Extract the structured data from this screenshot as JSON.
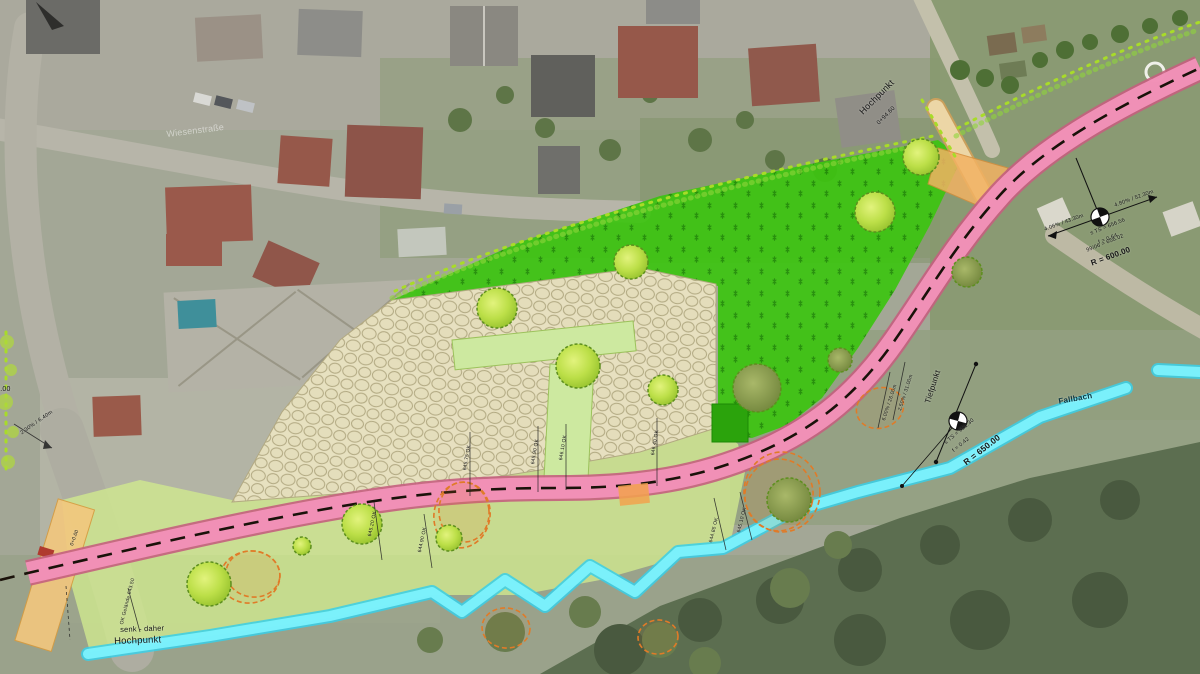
{
  "map": {
    "kind": "landscape-site-plan-over-aerial-photo",
    "colors": {
      "road_pink": "#f494bb",
      "road_edge": "#c45f7e",
      "road_centerline": "#1a120a",
      "meadow_green": "#3cc410",
      "light_green": "#cfe88e",
      "plaza_tan": "#eae3c2",
      "stream_cyan": "#7df2fd",
      "accent_orange": "#f2a24e",
      "boundary_chartreuse": "#a8dc28",
      "hedge_scribble_orange": "#e07b28"
    },
    "features": {
      "stream_name": "Fallbach",
      "high_point_label": "Hochpunkt",
      "low_point_label": "Tiefpunkt"
    }
  },
  "annotations": [
    {
      "id": "hochpunkt-top",
      "text": "Hochpunkt",
      "x": 858,
      "y": 110,
      "rot": -45,
      "size": 9
    },
    {
      "id": "hochpunkt-top-sub",
      "text": "0+94.60",
      "x": 876,
      "y": 122,
      "rot": -45,
      "size": 6
    },
    {
      "id": "grade-left",
      "text": "4.06% / 43.30m",
      "x": 1044,
      "y": 228,
      "rot": -20,
      "size": 5.5
    },
    {
      "id": "grade-right",
      "text": "4.80% / 52.30m",
      "x": 1114,
      "y": 204,
      "rot": -20,
      "size": 5.5
    },
    {
      "id": "curve1-line1",
      "text": "s TS = 656.56",
      "x": 1090,
      "y": 232,
      "rot": -22,
      "size": 5.5
    },
    {
      "id": "curve1-line2",
      "text": "f = 0.64",
      "x": 1098,
      "y": 241,
      "rot": -22,
      "size": 5.5
    },
    {
      "id": "curve1-line3",
      "text": "99/06 = 656.02",
      "x": 1086,
      "y": 249,
      "rot": -22,
      "size": 5.5
    },
    {
      "id": "curve1-radius",
      "text": "R = 600.00",
      "x": 1090,
      "y": 260,
      "rot": -20,
      "size": 8,
      "bold": true
    },
    {
      "id": "tiefpunkt",
      "text": "Tiefpunkt",
      "x": 924,
      "y": 402,
      "rot": -72,
      "size": 8
    },
    {
      "id": "grade-mid1",
      "text": "2.50% / 31.00m",
      "x": 898,
      "y": 410,
      "rot": -72,
      "size": 5
    },
    {
      "id": "grade-mid2",
      "text": "6.00% / 26.00m",
      "x": 882,
      "y": 420,
      "rot": -72,
      "size": 5
    },
    {
      "id": "curve2-line1",
      "text": "s TS = 651.30",
      "x": 944,
      "y": 442,
      "rot": -40,
      "size": 5.5
    },
    {
      "id": "curve2-line2",
      "text": "f = 0.42",
      "x": 952,
      "y": 450,
      "rot": -40,
      "size": 5.5
    },
    {
      "id": "curve2-radius",
      "text": "R = 650.00",
      "x": 962,
      "y": 460,
      "rot": -38,
      "size": 8.5,
      "bold": true
    },
    {
      "id": "stream-name",
      "text": "Fallbach",
      "x": 1058,
      "y": 398,
      "rot": -10,
      "size": 8,
      "bold": true,
      "color": "#0b3540"
    },
    {
      "id": "note-bottom-1",
      "text": "senk - daher",
      "x": 120,
      "y": 626,
      "rot": -2,
      "size": 7.5
    },
    {
      "id": "note-bottom-2",
      "text": "Hochpunkt",
      "x": 114,
      "y": 637,
      "rot": -2,
      "size": 9.5
    },
    {
      "id": "grade-west",
      "text": "2.30% / 6.40m",
      "x": 20,
      "y": 432,
      "rot": -35,
      "size": 5.5
    },
    {
      "id": "elev-west",
      "text": "600.00",
      "x": -12,
      "y": 386,
      "rot": 0,
      "size": 7
    },
    {
      "id": "elev-1",
      "text": "645.75 OK",
      "x": 463,
      "y": 470,
      "rot": -80,
      "size": 5
    },
    {
      "id": "elev-2",
      "text": "645.90 OK",
      "x": 531,
      "y": 464,
      "rot": -80,
      "size": 5
    },
    {
      "id": "elev-3",
      "text": "646.10 OK",
      "x": 559,
      "y": 460,
      "rot": -80,
      "size": 5
    },
    {
      "id": "elev-4",
      "text": "646.40 OK",
      "x": 651,
      "y": 455,
      "rot": -80,
      "size": 5
    },
    {
      "id": "elev-5",
      "text": "644.85 OK",
      "x": 709,
      "y": 542,
      "rot": -76,
      "size": 5
    },
    {
      "id": "elev-6",
      "text": "645.10 OK",
      "x": 737,
      "y": 532,
      "rot": -76,
      "size": 5
    },
    {
      "id": "elev-7",
      "text": "645.20 OK",
      "x": 368,
      "y": 536,
      "rot": -78,
      "size": 5
    },
    {
      "id": "elev-8",
      "text": "644.90 OK",
      "x": 418,
      "y": 552,
      "rot": -78,
      "size": 5
    },
    {
      "id": "elev-9",
      "text": "OK Gelände 643.50",
      "x": 120,
      "y": 624,
      "rot": -76,
      "size": 5
    },
    {
      "id": "station-0",
      "text": "0+0.00",
      "x": 70,
      "y": 545,
      "rot": -70,
      "size": 5
    },
    {
      "id": "street-name",
      "text": "Wiesenstraße",
      "x": 166,
      "y": 130,
      "rot": -7,
      "size": 9,
      "color": "#ffffff",
      "opacity": 0.5
    }
  ]
}
